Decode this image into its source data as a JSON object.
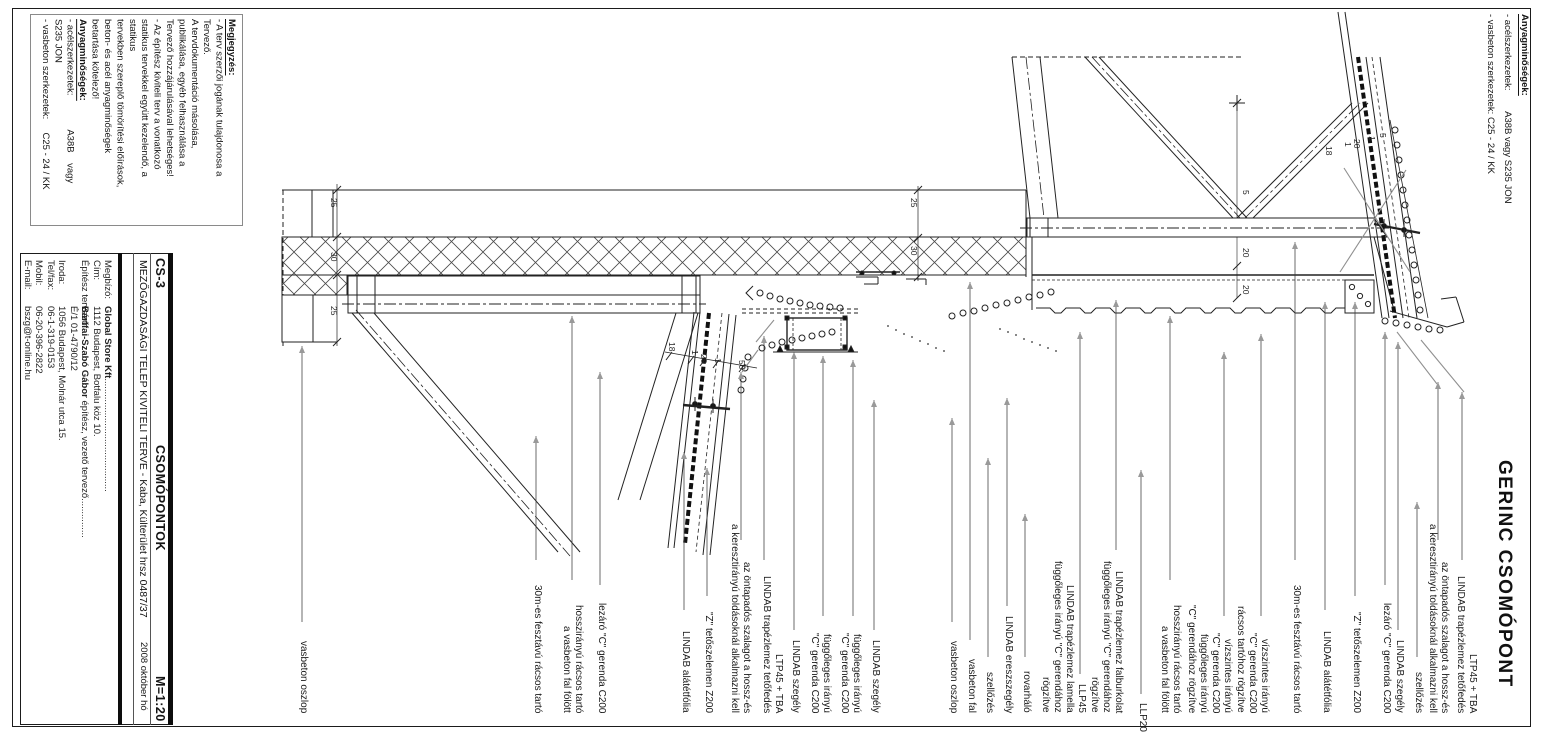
{
  "notes_block": {
    "title": "Megjegyzés:",
    "lines": [
      "- A terv szerzői jogának tulajdonosa a",
      "Tervező.",
      "A tervdokumentáció másolása,",
      "publikálása, egyéb felhasználása a",
      "Tervező hozzájárulásával lehetséges!",
      "- Az építész kiviteli terv a vonatkozó",
      "statikus tervekkel együtt kezelendő, a",
      "statikus",
      "tervekben szereplő tömörítési előírások,",
      "beton- és acél anyagminőségek",
      "betartása kötelező!"
    ],
    "materials_title": "Anyagminőségek:",
    "materials": [
      "- acélszerkezetek:             A38B    vagy",
      "S235 JON",
      "- vasbeton szerkezetek:     C25 - 24 / KK"
    ]
  },
  "top_right_notes": {
    "title": "Anyagminőségek:",
    "lines": [
      "- acélszerkezetek:        A38B vagy S235 JON",
      "- vasbeton szerkezetek: C25 - 24 / KK"
    ]
  },
  "title_block": {
    "project_line": "MEZŐGAZDASÁGI TELEP KIVITELI TERVE - Kaba, Külterület hrsz 0487/37",
    "date": "2008 október hó",
    "sheet_code": "CS-3",
    "sheet_name": "CSOMÓPONTOK",
    "scale": "M=1:20",
    "rows": [
      {
        "label": "Megbízó:",
        "value_bold": "Global Store Kft",
        "value": "..........................................."
      },
      {
        "label": "Cím:",
        "value": "1112 Budapest, Botfalu köz 10."
      },
      {
        "label": "Építész tervező:",
        "value_bold": "Bártfai-Szabó Gábor",
        "value": " építész, vezető tervező..............."
      },
      {
        "label": "",
        "value": "É/1 01-4790/12"
      },
      {
        "label": "Iroda:",
        "value": "1056 Budapest, Molnár utca 15."
      },
      {
        "label": "Tel/fax:",
        "value": "06-1-319-0153"
      },
      {
        "label": "Mobil:",
        "value": "06-20-396-2822"
      },
      {
        "label": "E-mail:",
        "value": "bszg@t-online.hu"
      }
    ]
  },
  "drawing": {
    "title": "GERINC CSOMÓPONT",
    "labels": [
      {
        "x": 309,
        "text": "vasbeton oszlop",
        "leader": [
          302,
          346,
          622
        ]
      },
      {
        "x": 543,
        "text": "30m-es fesztávú rácsos tartó",
        "leader": [
          536,
          436,
          560
        ]
      },
      {
        "x": 584,
        "text": "hosszirányú rácsos tartó\na vasbeton fal fölött",
        "leader": [
          572,
          316,
          580
        ]
      },
      {
        "x": 607,
        "text": "lezáró \"C\" gerenda C200",
        "leader": [
          600,
          372,
          585
        ]
      },
      {
        "x": 691,
        "text": "LINDAB alátétfólia",
        "leader": [
          684,
          452,
          610
        ]
      },
      {
        "x": 714,
        "text": "\"Z\" tetőszelemen Z200",
        "leader": [
          707,
          468,
          596
        ]
      },
      {
        "x": 752,
        "text": "az öntapadós szalagot a hossz-és\na keresztirányú toldásoknál alkalmazni kell",
        "leader": [
          741,
          372,
          540
        ]
      },
      {
        "x": 784,
        "text": "LTP45 + TBA\nLINDAB trapézlemez tetőfedés",
        "leader": [
          764,
          336,
          560
        ]
      },
      {
        "x": 801,
        "text": "LINDAB szegély",
        "leader": [
          794,
          352,
          630
        ]
      },
      {
        "x": 832,
        "text": "függőleges irányú\n\"C\" gerenda C200",
        "leader": [
          823,
          356,
          616
        ]
      },
      {
        "x": 862,
        "text": "függőleges irányú\n\"C\" gerenda C200",
        "leader": [
          853,
          360,
          616
        ]
      },
      {
        "x": 881,
        "text": "LINDAB szegély",
        "leader": [
          874,
          400,
          630
        ]
      },
      {
        "x": 959,
        "text": "vasbeton oszlop",
        "leader": [
          952,
          418,
          622
        ]
      },
      {
        "x": 977,
        "text": "vasbeton fal",
        "leader": [
          970,
          282,
          640
        ]
      },
      {
        "x": 995,
        "text": "szellőzés",
        "leader": [
          988,
          458,
          657
        ]
      },
      {
        "x": 1014,
        "text": "LINDAB ereszszegély",
        "leader": [
          1007,
          398,
          606
        ]
      },
      {
        "x": 1032,
        "text": "rovarháló",
        "leader": [
          1025,
          514,
          657
        ]
      },
      {
        "x": 1087,
        "text": "LLP45\nLINDAB trapézlemez lamella\nfüggőleges irányú \"C\" gerendához\nrögzítve",
        "leader": [
          1080,
          332,
          674
        ]
      },
      {
        "x": 1124,
        "text": "LINDAB trapézlemez falburkolat\nfüggőleges irányú \"C\" gerendához\nrögzítve",
        "leader": [
          1116,
          300,
          550
        ]
      },
      {
        "x": 1148,
        "text": "LLP20",
        "leader": [
          1141,
          470,
          694
        ],
        "bottom": 4
      },
      {
        "x": 1182,
        "text": "hosszirányú rácsos tartó\na vasbeton fal fölött",
        "leader": [
          1170,
          316,
          580
        ]
      },
      {
        "x": 1233,
        "text": "vízszintes irányú\n\"C\" gerenda C200\nfüggőleges irányú\n\"C\" gerendához rögzítve",
        "leader": [
          1224,
          352,
          616
        ]
      },
      {
        "x": 1270,
        "text": "vízszintes irányú\n\"C\" gerenda C200\nrácsos tartóhoz rögzítve",
        "leader": [
          1261,
          334,
          616
        ]
      },
      {
        "x": 1302,
        "text": "30m-es fesztávú rácsos tartó",
        "leader": [
          1295,
          242,
          560
        ]
      },
      {
        "x": 1332,
        "text": "LINDAB alátétfólia",
        "leader": [
          1325,
          302,
          610
        ]
      },
      {
        "x": 1362,
        "text": "\"Z\" tetőszelemen Z200",
        "leader": [
          1355,
          302,
          596
        ]
      },
      {
        "x": 1392,
        "text": "lezáró \"C\" gerenda C200",
        "leader": [
          1385,
          332,
          585
        ]
      },
      {
        "x": 1405,
        "text": "LINDAB szegély",
        "leader": [
          1398,
          342,
          630
        ]
      },
      {
        "x": 1424,
        "text": "szellőzés",
        "leader": [
          1417,
          502,
          657
        ]
      },
      {
        "x": 1450,
        "text": "az öntapadós szalagot a hossz-és\na keresztirányú toldásoknál alkalmazni kell",
        "leader": [
          1438,
          382,
          540
        ]
      },
      {
        "x": 1478,
        "text": "LTP45 + TBA\nLINDAB trapézlemez tetőfedés",
        "leader": [
          1462,
          392,
          560
        ]
      }
    ],
    "dims": [
      {
        "t": "25",
        "x": 329,
        "y": 198
      },
      {
        "t": "30",
        "x": 329,
        "y": 252
      },
      {
        "t": "25",
        "x": 329,
        "y": 306
      },
      {
        "t": "25",
        "x": 909,
        "y": 198
      },
      {
        "t": "30",
        "x": 909,
        "y": 246
      },
      {
        "t": "18",
        "x": 667,
        "y": 342
      },
      {
        "t": "1",
        "x": 690,
        "y": 350
      },
      {
        "t": "20",
        "x": 699,
        "y": 354
      },
      {
        "t": "1",
        "x": 713,
        "y": 358
      },
      {
        "t": "50",
        "x": 737,
        "y": 360
      },
      {
        "t": "18",
        "x": 1324,
        "y": 146
      },
      {
        "t": "1",
        "x": 1343,
        "y": 142
      },
      {
        "t": "20",
        "x": 1352,
        "y": 139
      },
      {
        "t": "1",
        "x": 1367,
        "y": 136
      },
      {
        "t": "5",
        "x": 1378,
        "y": 133
      },
      {
        "t": "5",
        "x": 1241,
        "y": 190
      },
      {
        "t": "20",
        "x": 1241,
        "y": 248
      },
      {
        "t": "20",
        "x": 1241,
        "y": 285
      }
    ]
  }
}
